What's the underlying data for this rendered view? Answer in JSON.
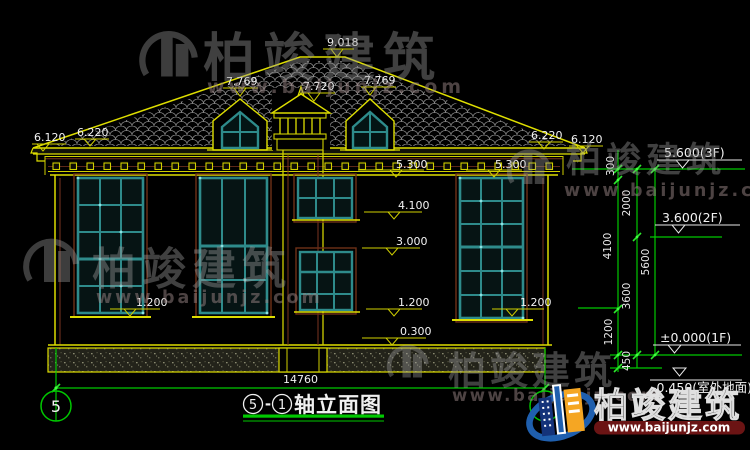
{
  "labels": {
    "peak": "9.018",
    "dormer_left": "7.769",
    "cupola": "7.720",
    "dormer_right": "7.769",
    "eave_left_outer": "6.120",
    "eave_left_inner": "6.220",
    "eave_right_inner": "6.220",
    "eave_right_outer": "6.120",
    "cornice_left": "5.300",
    "cornice_right": "5.300",
    "level_4100": "4.100",
    "level_3000": "3.000",
    "sill_left": "1.200",
    "sill_center": "1.200",
    "sill_right": "1.200",
    "level_0300": "0.300",
    "total_width": "14760"
  },
  "chain": {
    "c300": "300",
    "c2000": "2000",
    "c4100": "4100",
    "c3600": "3600",
    "c5600": "5600",
    "c1200": "1200",
    "c450": "450"
  },
  "levels": {
    "f3": "5.600(3F)",
    "f2": "3.600(2F)",
    "f1": "±0.000(1F)",
    "ground": "-0.450(室外地面)"
  },
  "axes": {
    "left": "5",
    "right": "1"
  },
  "title": {
    "axis_from": "5",
    "dash": "-",
    "axis_to": "1",
    "name": "轴立面图"
  },
  "watermark": {
    "brand": "柏竣建筑",
    "url": "www.baijunjz.com"
  },
  "colors": {
    "line_yellow": "#dede00",
    "line_green": "#00c800",
    "window_teal": "#2e8b8b",
    "accent_brown": "#7a3520",
    "logo_blue": "#1f5fae",
    "logo_orange": "#f5a623"
  }
}
